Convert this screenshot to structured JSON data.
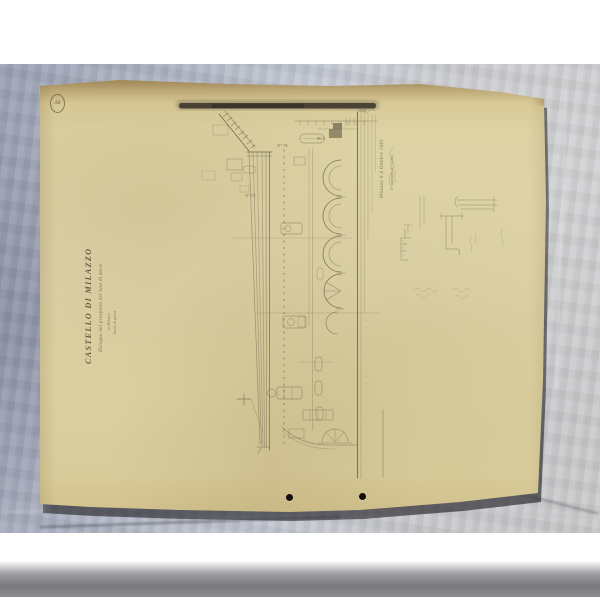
{
  "colors": {
    "backdrop_left": "#9ba2b5",
    "backdrop_right": "#cbcbcd",
    "backdrop_bottom": "#77777d",
    "paper": "#ddd2a4",
    "paper_edge": "#c2ad7a",
    "graphite_ink": "#67624e",
    "scale_bar": "#453d32",
    "punch_hole": "#120d06",
    "frame_white": "#ffffff"
  },
  "stamp": {
    "text": "AR"
  },
  "inscription": {
    "title": "Castello di Milazzo",
    "subtitle_lines": [
      "Disegno del prospetto del lato di mare",
      "in Milazzo",
      "Scala di palmi"
    ]
  },
  "annotations": {
    "signature_lines": [
      "Milazzo lì 4 Ottobre 1841",
      "Il Capitano del Genio"
    ],
    "labels": [
      {
        "text": "N° 74"
      },
      {
        "text": "N° 73"
      },
      {
        "text": "89.3"
      },
      {
        "text": "2.61"
      }
    ]
  }
}
